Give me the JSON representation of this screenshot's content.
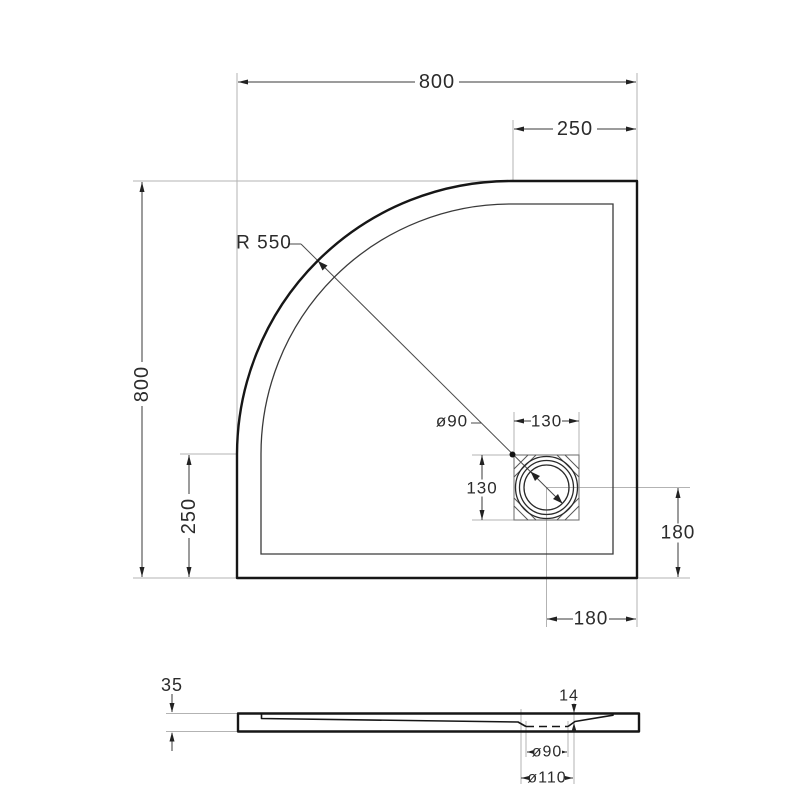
{
  "meta": {
    "title": "Quadrant shower tray technical drawing",
    "background": "#ffffff",
    "line_color": "#161616",
    "dimension_color": "#2b2b2b",
    "extension_color": "#b3b3b3"
  },
  "plan_view": {
    "width_label": "800",
    "height_label": "800",
    "corner_offset_top_label": "250",
    "corner_offset_left_label": "250",
    "corner_radius_label": "R 550",
    "drain": {
      "diameter_label": "ø90",
      "box_width_label": "130",
      "box_height_label": "130",
      "offset_from_right_label": "180",
      "offset_from_bottom_label": "180"
    }
  },
  "section_view": {
    "tray_height_label": "35",
    "drain_recess_depth_label": "14",
    "drain_hole_diameter_label": "ø90",
    "drain_flange_diameter_label": "ø110"
  }
}
